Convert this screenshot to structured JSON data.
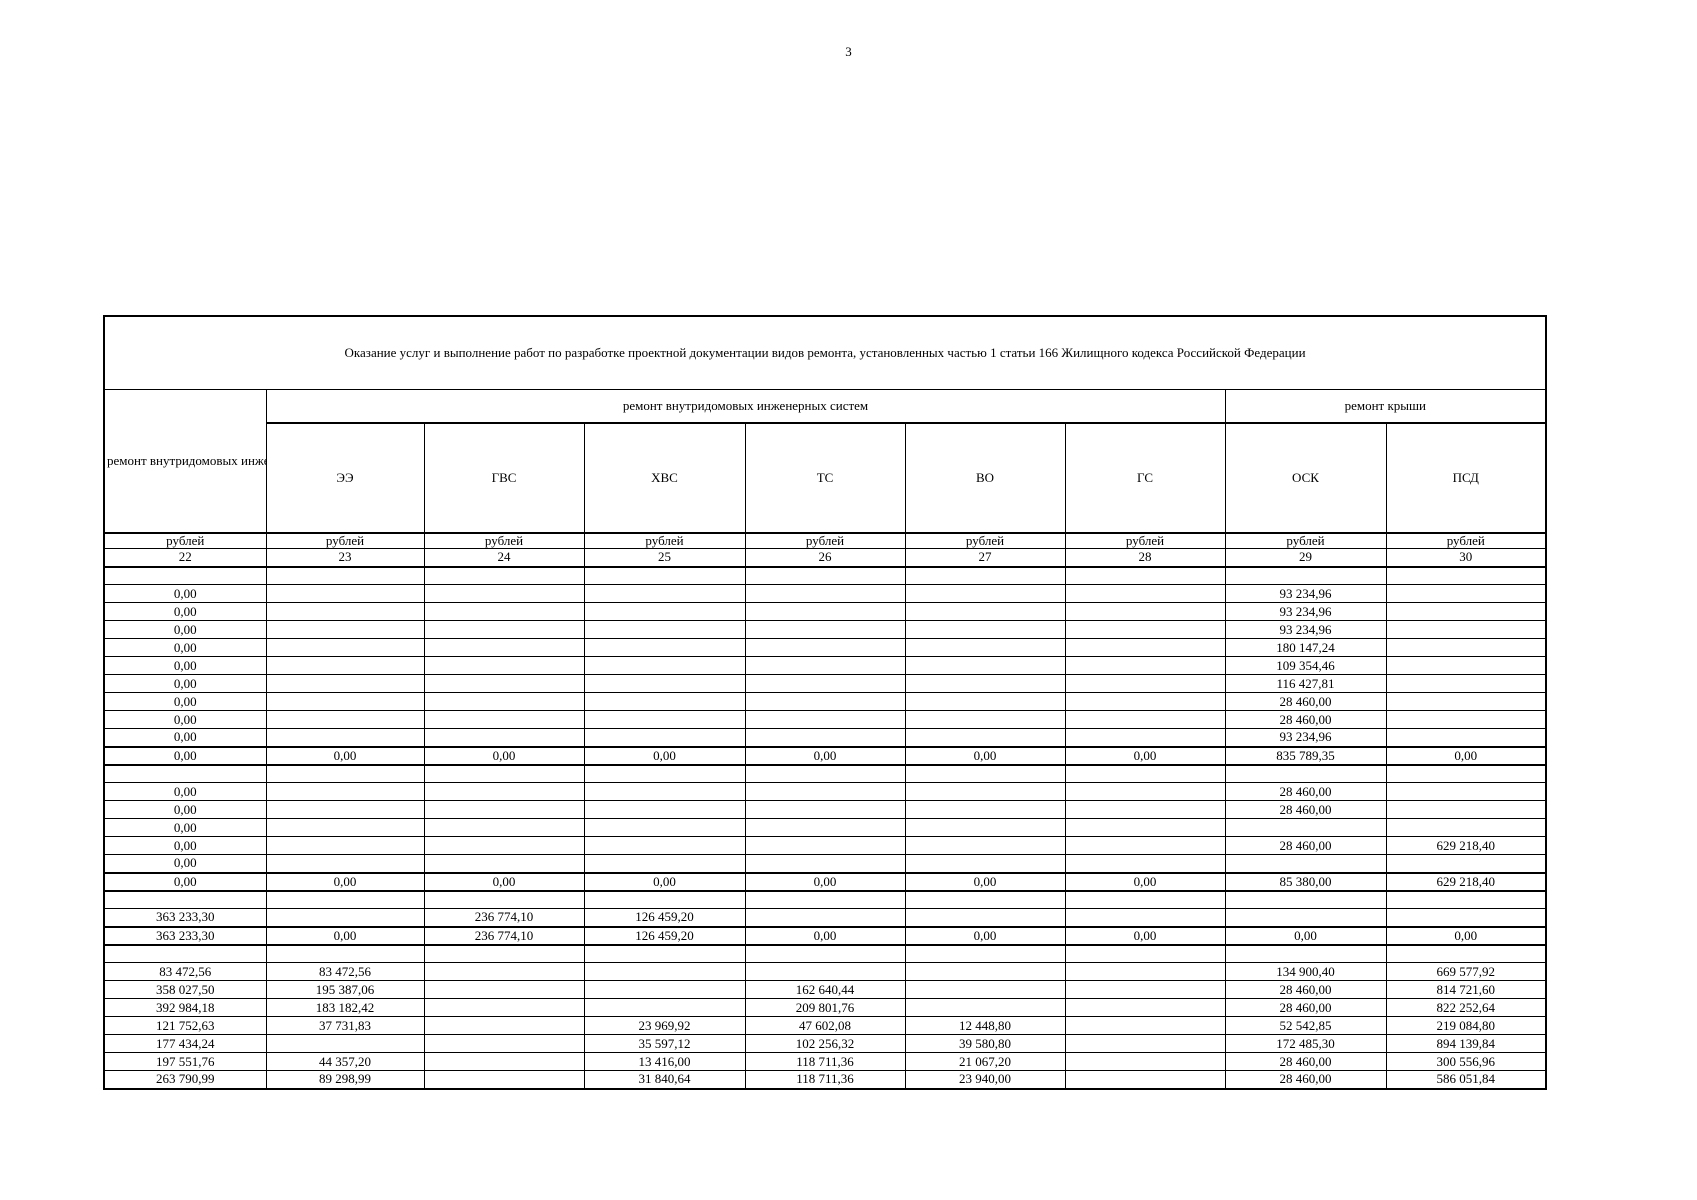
{
  "page": {
    "number": "3"
  },
  "colors": {
    "text": "#000000",
    "background": "#ffffff",
    "border": "#000000"
  },
  "table": {
    "title": "Оказание услуг и выполнение работ по разработке проектной  документации видов ремонта, установленных частью 1 статьи 166 Жилищного кодекса Российской Федерации",
    "row_header": "ремонт внутридомовых инженерных систем",
    "groups": [
      {
        "label": "ремонт внутридомовых инженерных систем",
        "span": 6
      },
      {
        "label": "ремонт крыши",
        "span": 2
      }
    ],
    "columns": [
      "ЭЭ",
      "ГВС",
      "ХВС",
      "ТС",
      "ВО",
      "ГС",
      "ОСК",
      "ПСД"
    ],
    "unit_label": "рублей",
    "col_numbers": [
      "22",
      "23",
      "24",
      "25",
      "26",
      "27",
      "28",
      "29",
      "30"
    ],
    "rows": [
      {
        "total": false,
        "cells": [
          "",
          "",
          "",
          "",
          "",
          "",
          "",
          "",
          ""
        ]
      },
      {
        "total": false,
        "cells": [
          "0,00",
          "",
          "",
          "",
          "",
          "",
          "",
          "93 234,96",
          ""
        ]
      },
      {
        "total": false,
        "cells": [
          "0,00",
          "",
          "",
          "",
          "",
          "",
          "",
          "93 234,96",
          ""
        ]
      },
      {
        "total": false,
        "cells": [
          "0,00",
          "",
          "",
          "",
          "",
          "",
          "",
          "93 234,96",
          ""
        ]
      },
      {
        "total": false,
        "cells": [
          "0,00",
          "",
          "",
          "",
          "",
          "",
          "",
          "180 147,24",
          ""
        ]
      },
      {
        "total": false,
        "cells": [
          "0,00",
          "",
          "",
          "",
          "",
          "",
          "",
          "109 354,46",
          ""
        ]
      },
      {
        "total": false,
        "cells": [
          "0,00",
          "",
          "",
          "",
          "",
          "",
          "",
          "116 427,81",
          ""
        ]
      },
      {
        "total": false,
        "cells": [
          "0,00",
          "",
          "",
          "",
          "",
          "",
          "",
          "28 460,00",
          ""
        ]
      },
      {
        "total": false,
        "cells": [
          "0,00",
          "",
          "",
          "",
          "",
          "",
          "",
          "28 460,00",
          ""
        ]
      },
      {
        "total": false,
        "cells": [
          "0,00",
          "",
          "",
          "",
          "",
          "",
          "",
          "93 234,96",
          ""
        ]
      },
      {
        "total": true,
        "cells": [
          "0,00",
          "0,00",
          "0,00",
          "0,00",
          "0,00",
          "0,00",
          "0,00",
          "835 789,35",
          "0,00"
        ]
      },
      {
        "total": false,
        "cells": [
          "",
          "",
          "",
          "",
          "",
          "",
          "",
          "",
          ""
        ]
      },
      {
        "total": false,
        "cells": [
          "0,00",
          "",
          "",
          "",
          "",
          "",
          "",
          "28 460,00",
          ""
        ]
      },
      {
        "total": false,
        "cells": [
          "0,00",
          "",
          "",
          "",
          "",
          "",
          "",
          "28 460,00",
          ""
        ]
      },
      {
        "total": false,
        "cells": [
          "0,00",
          "",
          "",
          "",
          "",
          "",
          "",
          "",
          ""
        ]
      },
      {
        "total": false,
        "cells": [
          "0,00",
          "",
          "",
          "",
          "",
          "",
          "",
          "28 460,00",
          "629 218,40"
        ]
      },
      {
        "total": false,
        "cells": [
          "0,00",
          "",
          "",
          "",
          "",
          "",
          "",
          "",
          ""
        ]
      },
      {
        "total": true,
        "cells": [
          "0,00",
          "0,00",
          "0,00",
          "0,00",
          "0,00",
          "0,00",
          "0,00",
          "85 380,00",
          "629 218,40"
        ]
      },
      {
        "total": false,
        "cells": [
          "",
          "",
          "",
          "",
          "",
          "",
          "",
          "",
          ""
        ]
      },
      {
        "total": false,
        "cells": [
          "363 233,30",
          "",
          "236 774,10",
          "126 459,20",
          "",
          "",
          "",
          "",
          ""
        ]
      },
      {
        "total": true,
        "cells": [
          "363 233,30",
          "0,00",
          "236 774,10",
          "126 459,20",
          "0,00",
          "0,00",
          "0,00",
          "0,00",
          "0,00"
        ]
      },
      {
        "total": false,
        "cells": [
          "",
          "",
          "",
          "",
          "",
          "",
          "",
          "",
          ""
        ]
      },
      {
        "total": false,
        "cells": [
          "83 472,56",
          "83 472,56",
          "",
          "",
          "",
          "",
          "",
          "134 900,40",
          "669 577,92"
        ]
      },
      {
        "total": false,
        "cells": [
          "358 027,50",
          "195 387,06",
          "",
          "",
          "162 640,44",
          "",
          "",
          "28 460,00",
          "814 721,60"
        ]
      },
      {
        "total": false,
        "cells": [
          "392 984,18",
          "183 182,42",
          "",
          "",
          "209 801,76",
          "",
          "",
          "28 460,00",
          "822 252,64"
        ]
      },
      {
        "total": false,
        "cells": [
          "121 752,63",
          "37 731,83",
          "",
          "23 969,92",
          "47 602,08",
          "12 448,80",
          "",
          "52 542,85",
          "219 084,80"
        ]
      },
      {
        "total": false,
        "cells": [
          "177 434,24",
          "",
          "",
          "35 597,12",
          "102 256,32",
          "39 580,80",
          "",
          "172 485,30",
          "894 139,84"
        ]
      },
      {
        "total": false,
        "cells": [
          "197 551,76",
          "44 357,20",
          "",
          "13 416,00",
          "118 711,36",
          "21 067,20",
          "",
          "28 460,00",
          "300 556,96"
        ]
      },
      {
        "total": false,
        "cells": [
          "263 790,99",
          "89 298,99",
          "",
          "31 840,64",
          "118 711,36",
          "23 940,00",
          "",
          "28 460,00",
          "586 051,84"
        ]
      }
    ]
  }
}
